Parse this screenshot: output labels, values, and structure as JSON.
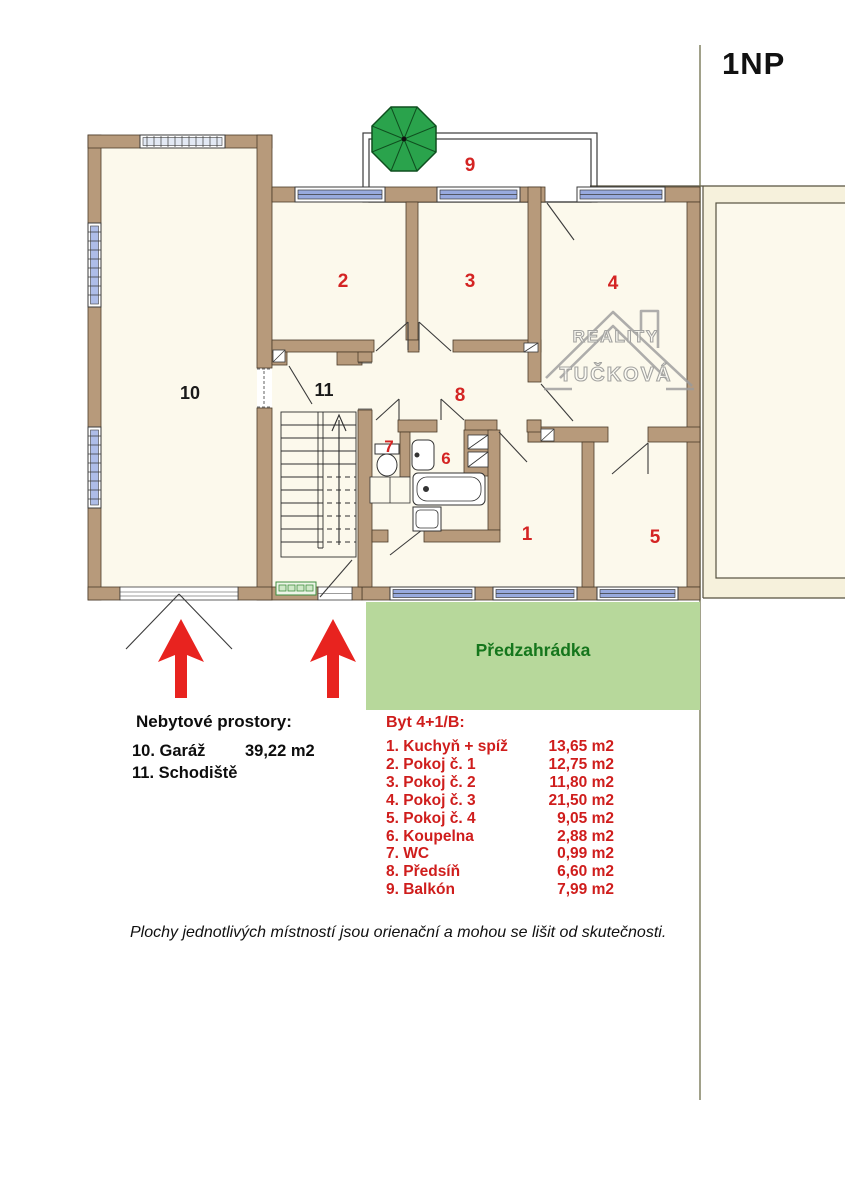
{
  "header": {
    "floor_label": "1NP"
  },
  "plan": {
    "room_numbers": [
      "1",
      "2",
      "3",
      "4",
      "5",
      "6",
      "7",
      "8",
      "9",
      "10",
      "11"
    ],
    "garden_label": "Předzahrádka",
    "watermark": {
      "line1": "REALITY",
      "line2": "TUČKOVÁ"
    }
  },
  "legend_nonresidential": {
    "title": "Nebytové prostory:",
    "items": [
      {
        "label": "10. Garáž",
        "area": "39,22 m2"
      },
      {
        "label": "11. Schodiště",
        "area": ""
      }
    ]
  },
  "legend_apartment": {
    "title": "Byt 4+1/B:",
    "items": [
      {
        "label": "1. Kuchyň + spíž",
        "area": "13,65 m2"
      },
      {
        "label": "2. Pokoj č. 1",
        "area": "12,75 m2"
      },
      {
        "label": "3. Pokoj č. 2",
        "area": "11,80 m2"
      },
      {
        "label": "4. Pokoj č. 3",
        "area": "21,50 m2"
      },
      {
        "label": "5. Pokoj č. 4",
        "area": "9,05 m2"
      },
      {
        "label": "6. Koupelna",
        "area": "2,88 m2"
      },
      {
        "label": "7. WC",
        "area": "0,99 m2"
      },
      {
        "label": "8. Předsíň",
        "area": "6,60 m2"
      },
      {
        "label": "9. Balkón",
        "area": "7,99 m2"
      }
    ]
  },
  "disclaimer": "Plochy jednotlivých místností jsou orienační a mohou se lišit od skutečnosti.",
  "colors": {
    "wall": "#b79a7b",
    "room_fill": "#fcf9ec",
    "window_blue": "#98aade",
    "garden_green": "#b7d89b",
    "garden_text": "#15761c",
    "arrow_red": "#e8231f",
    "label_red": "#d42423",
    "umbrella_green": "#2aa34c"
  }
}
